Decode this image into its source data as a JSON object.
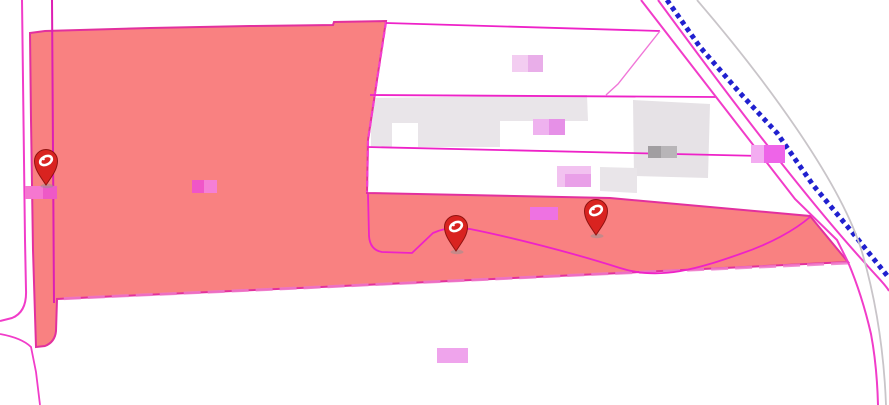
{
  "map": {
    "canvas": {
      "width": 889,
      "height": 405,
      "background": "#ffffff"
    },
    "palette": {
      "parcel_fill": "#f98181",
      "parcel_border": "#e2309e",
      "cadastral_magenta": "#ee22c8",
      "road_magenta": "#f13cc9",
      "dash_pale_pink": "#ef79c9",
      "dash_bright_pink": "#f53fd0",
      "railway_blue": "#2020cf",
      "terrain_gray": "#c9c5c9",
      "building_gray": "#e9e5e9",
      "pin_red": "#d92320",
      "pin_outline": "#8f1210",
      "pin_glyph_white": "#ffffff"
    },
    "layers": [
      {
        "name": "building-row",
        "type": "path",
        "d": "M371,98 L587,95 L588,121 L500,121 L500,147 L418,147 L418,123 L392,123 L392,147 L371,147 Z",
        "fill": "#e9e5e9"
      },
      {
        "name": "building-block",
        "type": "path",
        "d": "M633,100 L710,104 L708,178 L634,176 Z",
        "fill": "#e6e2e6"
      },
      {
        "name": "building-small",
        "type": "path",
        "d": "M600,167 L637,168 L637,193 L600,191 Z",
        "fill": "#e9e5e9"
      },
      {
        "name": "highlighted-parcel",
        "type": "path",
        "d": "M30,33 L45,31 L150,28 L250,26 L333,25 L334,22 L386,21 L377,80 L368,140 L367,193 L610,198 L810,216 L848,262 L600,274 L300,288 L120,296 L57,299 L56,331 Q55,342 45,346 L36,347 L33,250 L31,120 Z",
        "fill": "#f98181",
        "stroke": "#e2309e",
        "width": 2
      },
      {
        "name": "parcel-edge-dash-right",
        "type": "path",
        "d": "M386,22 L377,80 L368,140 L367,192",
        "stroke": "#f53fd0",
        "width": 2.2,
        "dash": "6 4"
      },
      {
        "name": "parcel-edge-dash-bottom",
        "type": "path",
        "d": "M848,263 L600,274 L300,288 L120,296 L57,299",
        "stroke": "#ef79c9",
        "width": 3,
        "dash": "17 7",
        "opacity": 0.85
      },
      {
        "name": "parcel-line-vertical",
        "type": "path",
        "d": "M52,0 L53,150 L54,303",
        "stroke": "#dd1fb4",
        "width": 2
      },
      {
        "name": "road-edge-left-outer",
        "type": "path",
        "d": "M22,0 L25,240 L26,290 Q27,312 12,318 L0,321",
        "stroke": "#f13cc9",
        "width": 2
      },
      {
        "name": "road-corner-curve",
        "type": "path",
        "d": "M0,334 Q22,338 31,347 L36,372 L40,405",
        "stroke": "#f13cc9",
        "width": 1.8
      },
      {
        "name": "parcel-line-top",
        "type": "path",
        "d": "M386,23 L660,31",
        "stroke": "#ee22c8",
        "width": 1.8
      },
      {
        "name": "parcel-line-branch",
        "type": "path",
        "d": "M660,31 L618,84 L606,95",
        "stroke": "#f077d8",
        "width": 1.4
      },
      {
        "name": "parcel-line-mid",
        "type": "path",
        "d": "M370,95 L716,97",
        "stroke": "#ee22c8",
        "width": 1.8
      },
      {
        "name": "parcel-line-lower",
        "type": "path",
        "d": "M367,147 L762,156",
        "stroke": "#ee22c8",
        "width": 1.8
      },
      {
        "name": "parcel-boundary-curve",
        "type": "path",
        "d": "M368,194 L369,236 Q370,250 382,252 L412,253 L433,233 Q444,228 456,228 L470,229 C510,237 570,252 620,268 C660,281 700,268 740,254 C770,244 795,230 810,217",
        "stroke": "#ee22c8",
        "width": 1.8
      },
      {
        "name": "road-edge-diagonal-1",
        "type": "path",
        "d": "M641,0 L795,199 L837,240 L848,262 Q862,295 871,334 Q877,366 878,405",
        "stroke": "#f13cc9",
        "width": 2
      },
      {
        "name": "road-edge-diagonal-2",
        "type": "path",
        "d": "M658,0 C740,112 812,205 865,263 C878,278 886,285 889,291",
        "stroke": "#f13cc9",
        "width": 2
      },
      {
        "name": "railway-line",
        "type": "polyline",
        "points": "667,0 700,47 740,93 777,133 813,185 852,232 889,278",
        "stroke": "#2020cf",
        "width": 5,
        "dash": "4.5 4",
        "linecap": "butt"
      },
      {
        "name": "terrain-line",
        "type": "path",
        "d": "M697,0 C770,85 842,185 862,252 C876,300 884,352 886,405",
        "stroke": "#c9c5c9",
        "width": 1.8
      },
      {
        "name": "map-labels",
        "type": "rects",
        "rects": [
          {
            "x": 512,
            "y": 55,
            "w": 16,
            "h": 17,
            "fill": "#f3cdf1"
          },
          {
            "x": 528,
            "y": 55,
            "w": 15,
            "h": 17,
            "fill": "#e9aee9"
          },
          {
            "x": 533,
            "y": 119,
            "w": 16,
            "h": 16,
            "fill": "#efb2ef"
          },
          {
            "x": 549,
            "y": 119,
            "w": 16,
            "h": 16,
            "fill": "#e690e7"
          },
          {
            "x": 557,
            "y": 166,
            "w": 34,
            "h": 21,
            "fill": "#f2c2f0"
          },
          {
            "x": 565,
            "y": 174,
            "w": 26,
            "h": 13,
            "fill": "#e9a0e8"
          },
          {
            "x": 530,
            "y": 207,
            "w": 28,
            "h": 13,
            "fill": "#ee72e2"
          },
          {
            "x": 437,
            "y": 348,
            "w": 31,
            "h": 15,
            "fill": "#efa4ec"
          },
          {
            "x": 192,
            "y": 180,
            "w": 12,
            "h": 13,
            "fill": "#f055c8"
          },
          {
            "x": 204,
            "y": 180,
            "w": 13,
            "h": 13,
            "fill": "#f57fd6"
          },
          {
            "x": 751,
            "y": 145,
            "w": 13,
            "h": 18,
            "fill": "#f3acf1"
          },
          {
            "x": 764,
            "y": 145,
            "w": 21,
            "h": 18,
            "fill": "#ee64e8"
          },
          {
            "x": 648,
            "y": 146,
            "w": 13,
            "h": 12,
            "fill": "#a19ea1"
          },
          {
            "x": 661,
            "y": 146,
            "w": 16,
            "h": 12,
            "fill": "#b8b5b8"
          },
          {
            "x": 25,
            "y": 186,
            "w": 18,
            "h": 13,
            "fill": "#f577d0"
          },
          {
            "x": 43,
            "y": 186,
            "w": 14,
            "h": 13,
            "fill": "#ee59c6"
          }
        ]
      }
    ],
    "markers": [
      {
        "id": "marker-west",
        "x": 46,
        "y": 162
      },
      {
        "id": "marker-center",
        "x": 456,
        "y": 228
      },
      {
        "id": "marker-east",
        "x": 596,
        "y": 212
      }
    ]
  }
}
